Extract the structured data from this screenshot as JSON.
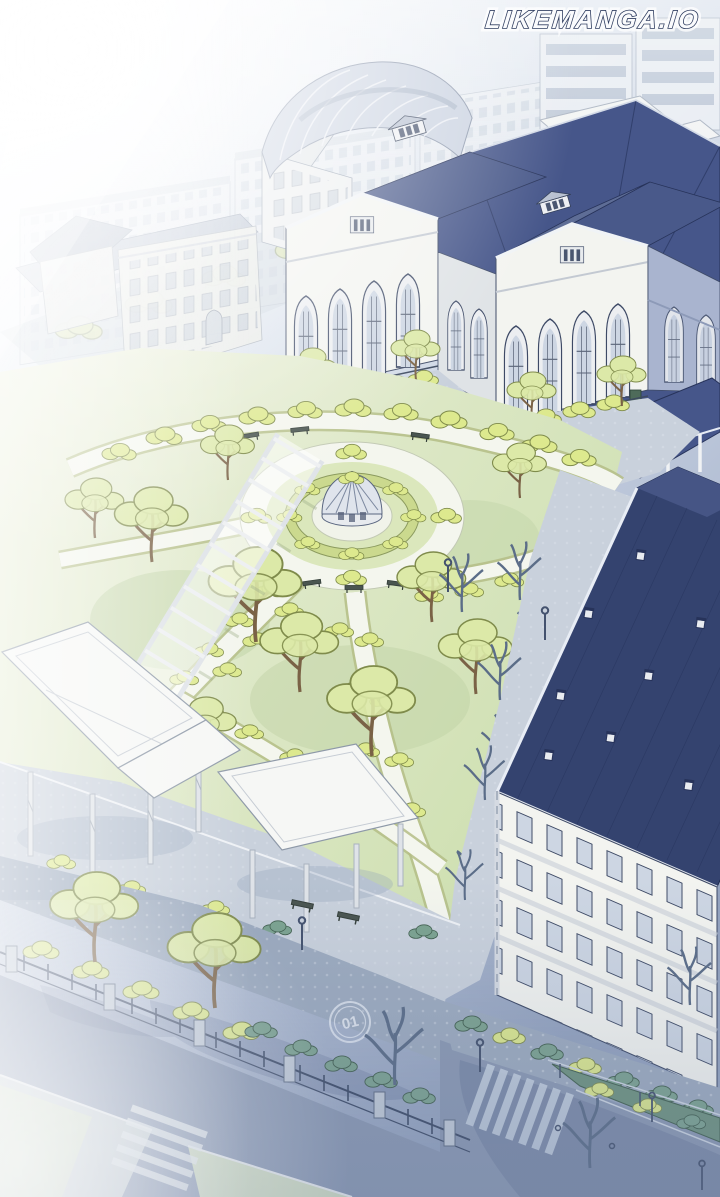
{
  "watermark": {
    "text": "LIKEMANGA.IO"
  },
  "road_marking": {
    "text": "01"
  },
  "scene": {
    "kind": "manhwa-panel-illustration",
    "alt": "Aerial isometric view of a school campus: gothic main hall with navy roofs, arched-roof hall, dormitory building, formal garden with domed fountain pavilion, pergola, white entrance canopies, tree-lined boulevard with fence and crosswalks, bright sunlight glare from upper left",
    "elements": [
      "city-skyline",
      "arched-roof-hall",
      "gothic-main-hall",
      "west-classroom-building",
      "dormitory-building",
      "formal-garden",
      "fountain-pavilion",
      "parterre",
      "pergola",
      "entrance-canopies",
      "boulevard",
      "campus-fence",
      "crosswalks",
      "street-lamps",
      "road-emblem",
      "sunlight-glare"
    ]
  },
  "palette": {
    "paper": "#e4eaf2",
    "city_wall": "#e9edf2",
    "city_window": "#b4c0d1",
    "roof_navy": "#34436f",
    "roof_navy_mid": "#46568a",
    "roof_slate": "#5e6d96",
    "roof_slate_dark": "#49598a",
    "roof_pale": "#ccd4e2",
    "wall_white": "#f3f4f0",
    "wall_shade": "#dfe3e6",
    "wall_blue_shade": "#a9b4cf",
    "window_glass": "#cdd6e3",
    "window_dark": "#4a5670",
    "lawn": "#d4e2b8",
    "lawn_pale": "#e7ecd8",
    "lawn_shade": "#bed1a4",
    "bush": "#dde98e",
    "bush_line": "#7f8b4b",
    "foliage_pale": "#dce9a8",
    "hedge_teal": "#7ca390",
    "hedge_teal_line": "#42604f",
    "path_white": "#f4f6ee",
    "path_edge": "#b4bd86",
    "pave_grey": "#c9d1dc",
    "pave_shade": "#9dabbf",
    "road_blue": "#8b99b3",
    "shadow_blue": "#4c5d85",
    "fence_iron": "#3c4a66",
    "stone": "#c3ccd8",
    "trunk": "#c9a87d",
    "trunk_line": "#7a6246",
    "branch_shade": "#5b6d88",
    "structure_white": "#f6f7f5",
    "structure_line": "#8e99a8",
    "outline_ink": "#333f57",
    "crosswalk": "#c9d4e2",
    "wm_fill": "#fafbfd",
    "wm_stroke": "#2e3c5f"
  }
}
